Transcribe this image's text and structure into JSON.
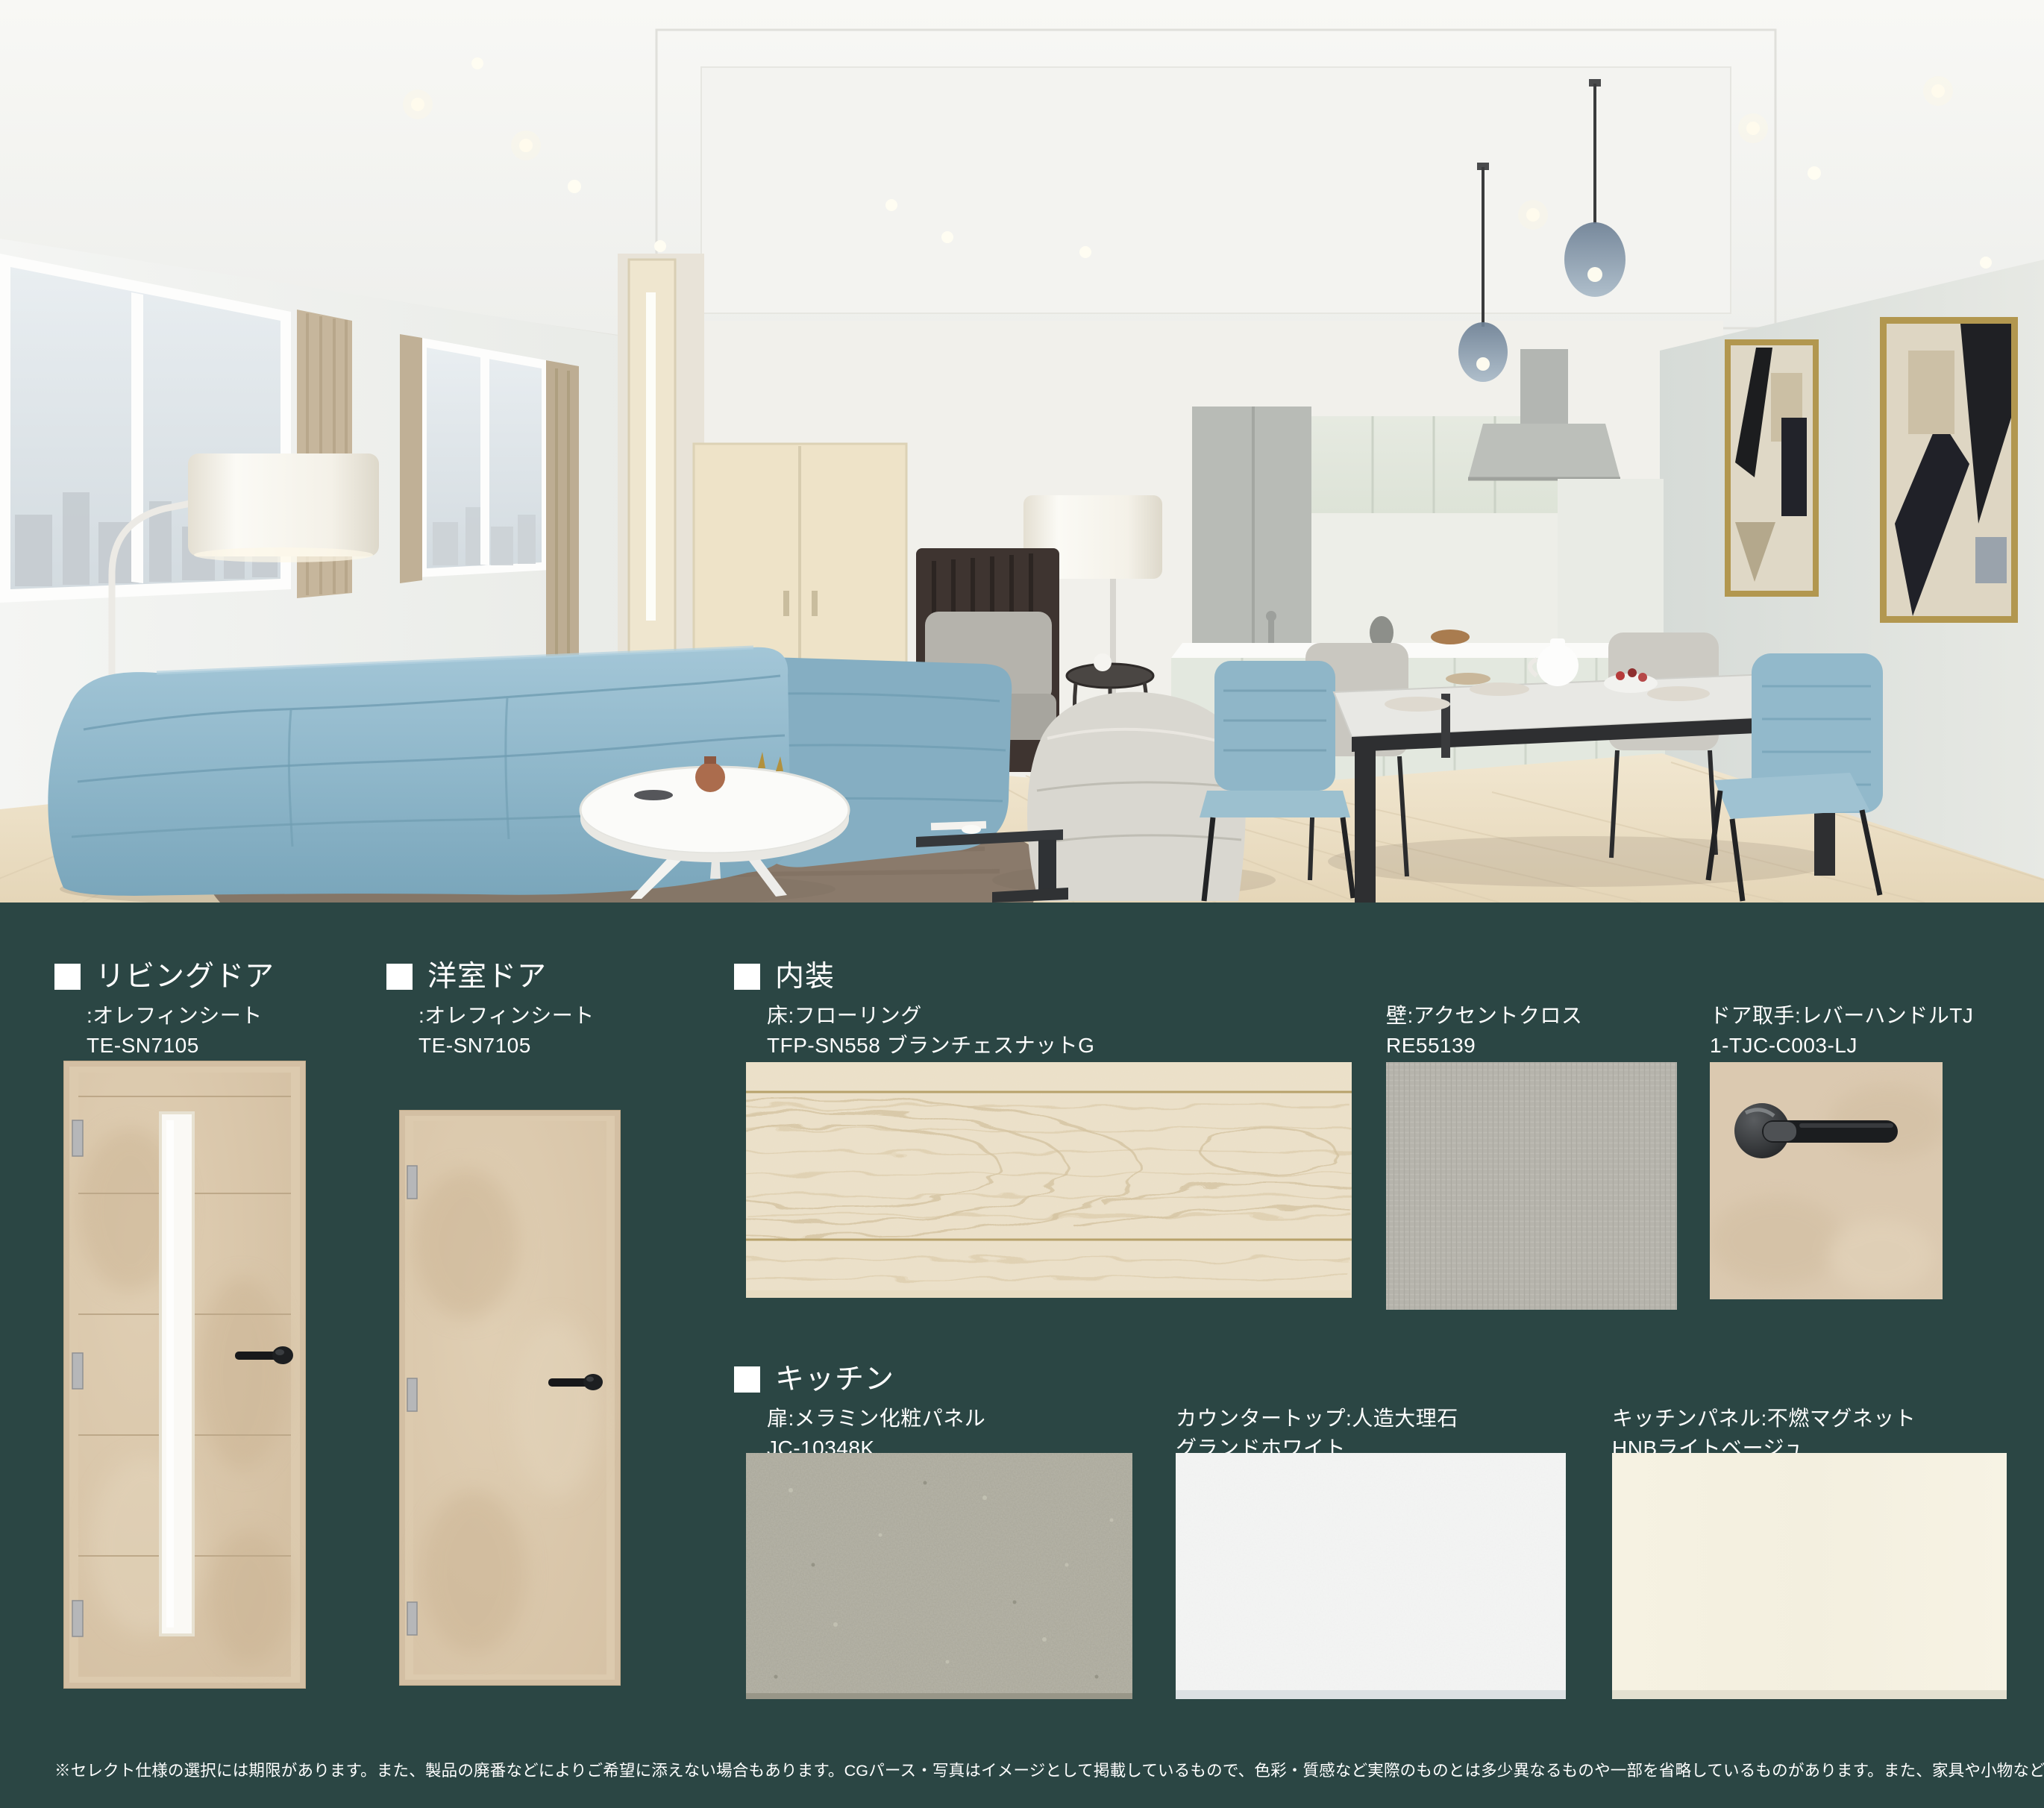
{
  "page": {
    "background_color": "#2b4644",
    "disclaimer": "※セレクト仕様の選択には期限があります。また、製品の廃番などによりご希望に添えない場合もあります。CGパース・写真はイメージとして掲載しているもので、色彩・質感など実際のものとは多少異なるものや一部を省略しているものがあります。また、家具や小物など販売価格に含まれていないものなどが表現されています。"
  },
  "hero": {
    "description": "リビング・ダイニング・キッチンのCGパース(青いソファ、白いフロアランプ、ダイニングセット、キッチン、アート2点)",
    "palette": {
      "ceiling": "#f6f6f3",
      "wall": "#f0f1ee",
      "accent_wall": "#dbe0dc",
      "floor_wood": "#ecdfc4",
      "sofa_blue": "#8fb7ca",
      "rug_brown": "#8a7a6b"
    }
  },
  "sections": {
    "living_door": {
      "title": "リビングドア",
      "lines": [
        ":オレフィンシート",
        "TE-SN7105"
      ]
    },
    "western_door": {
      "title": "洋室ドア",
      "lines": [
        ":オレフィンシート",
        "TE-SN7105"
      ]
    },
    "interior": {
      "title": "内装",
      "floor": {
        "lines": [
          "床:フローリング",
          "TFP-SN558 ブランチェスナットG"
        ]
      },
      "wall": {
        "lines": [
          "壁:アクセントクロス",
          "RE55139"
        ]
      },
      "handle": {
        "lines": [
          "ドア取手:レバーハンドルTJ",
          "1-TJC-C003-LJ"
        ]
      }
    },
    "kitchen": {
      "title": "キッチン",
      "door_panel": {
        "lines": [
          "扉:メラミン化粧パネル",
          "JC-10348K"
        ]
      },
      "countertop": {
        "lines": [
          "カウンタートップ:人造大理石",
          "グランドホワイト"
        ]
      },
      "panel": {
        "lines": [
          "キッチンパネル:不燃マグネット",
          "HNBライトベージュ"
        ]
      }
    }
  }
}
